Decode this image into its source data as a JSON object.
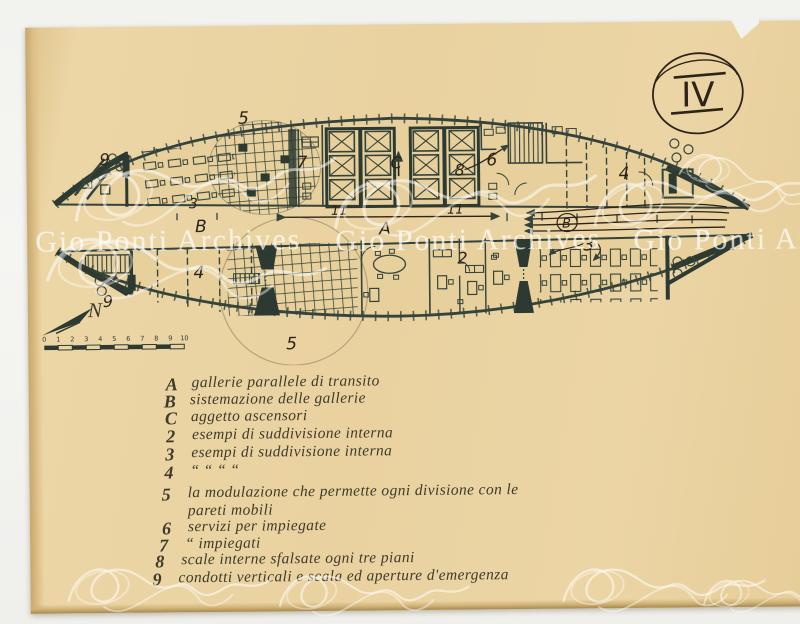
{
  "sheet": {
    "number": "IV"
  },
  "watermark": {
    "text": "Gio Ponti Archives"
  },
  "colors": {
    "paper": "#e9d2a0",
    "ink": "#34433b",
    "pen": "#3f3b2b",
    "background": "#f2f2ef",
    "watermark": "rgba(255,255,255,0.62)"
  },
  "plan": {
    "labels": {
      "top_area_5": "5",
      "top_area_9": "9",
      "top_area_3": "3",
      "room_7": "7",
      "core_c": "C",
      "stair_8": "8",
      "room_6": "6",
      "bay_11_left": "11",
      "bay_11_right": "11",
      "gallery_a": "A",
      "gallery_b": "B",
      "gallery_b_circled": "B",
      "top_area_4": "4",
      "bottom_area_9": "9",
      "bottom_area_4": "4",
      "bottom_area_5": "5",
      "room_2": "2",
      "bottom_area_3": "3"
    },
    "compass_n": "N",
    "scale_ticks": [
      "0",
      "1",
      "2",
      "3",
      "4",
      "5",
      "6",
      "7",
      "8",
      "9",
      "10"
    ]
  },
  "legend": {
    "items": [
      {
        "key": "A",
        "text": "gallerie parallele di transito"
      },
      {
        "key": "B",
        "text": "sistemazione delle gallerie"
      },
      {
        "key": "C",
        "text": "aggetto ascensori"
      },
      {
        "key": "2",
        "text": "esempi di suddivisione interna"
      },
      {
        "key": "3",
        "text": "esempi di suddivisione interna"
      },
      {
        "key": "4",
        "text": "“        “        “        “"
      },
      {
        "key": "5",
        "text": "la modulazione che permette ogni divisione con le\npareti mobili"
      },
      {
        "key": "6",
        "text": "servizi per impiegate"
      },
      {
        "key": "7",
        "text": "“     impiegati"
      },
      {
        "key": "8",
        "text": "scale interne sfalsate ogni tre piani"
      },
      {
        "key": "9",
        "text": "condotti verticali e scala ed aperture d'emergenza"
      }
    ]
  }
}
